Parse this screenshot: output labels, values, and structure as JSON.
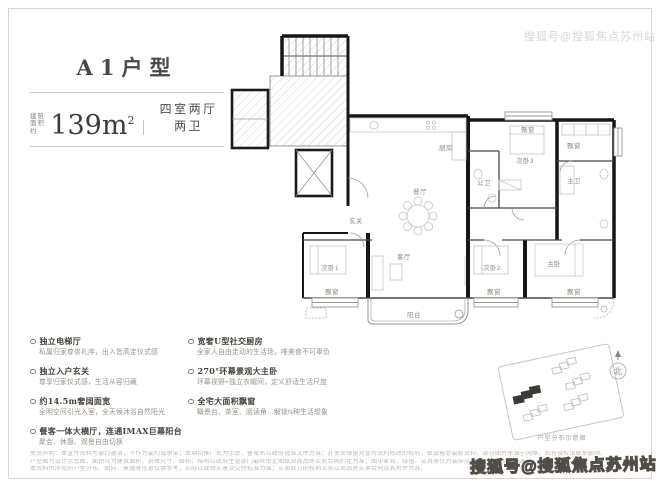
{
  "header": {
    "title": "A1户型",
    "area_prefix": [
      "建筑",
      "面积约"
    ],
    "area_value": "139m",
    "area_sup": "2",
    "layout": "四室两厅两卫"
  },
  "floorplan": {
    "rooms": {
      "kitchen": "厨房",
      "dining": "餐厅",
      "foyer": "玄关",
      "bath_public": "公卫",
      "bed3": "次卧3",
      "bath_master": "主卫",
      "bed1": "次卧1",
      "living": "客厅",
      "bed2": "次卧2",
      "master": "主卧",
      "balcony": "阳台",
      "bay": "飘窗"
    }
  },
  "features": {
    "left": [
      {
        "title": "独立电梯厅",
        "desc": "私属归家尊崇礼序，出入皆高定仪式感"
      },
      {
        "title": "独立入户玄关",
        "desc": "尊享归家仪式感，生活从容归藏"
      },
      {
        "title": "约14.5m奢阔面宽",
        "desc": "全明空间引光入室，全天候沐浴自然阳光"
      },
      {
        "title": "餐客一体大横厅，连通IMAX巨幕阳台",
        "desc": "聚会、休憩、观景自由切换"
      }
    ],
    "right": [
      {
        "title": "宽奢U型社交厨房",
        "desc": "全家人自由走动的生活场，唯美食不可辜负"
      },
      {
        "title": "270°环幕景观大主卧",
        "desc": "环幕视野+独立衣帽间，定义舒适生活尺度"
      },
      {
        "title": "全宅大面积飘窗",
        "desc": "瞰景台、茶室、阅读角…解锁N种生活想象"
      }
    ]
  },
  "keyplan": {
    "caption": "户型分布示意图"
  },
  "compass": {
    "label": "北"
  },
  "disclaimer": [
    "免责声明：本宣传资料为要约邀请，不作为要约或承诺；本项目推广名为示意，备案名以政府批准文件为准；开发商保留对宣传资料修改的权利，敬请留意最新资料，部分图片来源于网络，如有侵权请联系删除。",
    "户型图为设计示意图，面积均为建筑面积，具体尺寸、面积、结构以政府主管部门最终审定图纸及商品房买卖合同约定为准；图中家具、绿植、洁具等仅为装饰示意，不属于交付标准。",
    "本资料所涉及的户型分布、朝向、景观等信息仅供参考，实际以现场实景及交付标准为准；买卖双方的权利义务以商品房买卖合同及其附件为准。"
  ],
  "watermark": {
    "top": "搜狐号@搜狐焦点苏州站",
    "bottom": "搜狐号@搜狐焦点苏州站"
  }
}
